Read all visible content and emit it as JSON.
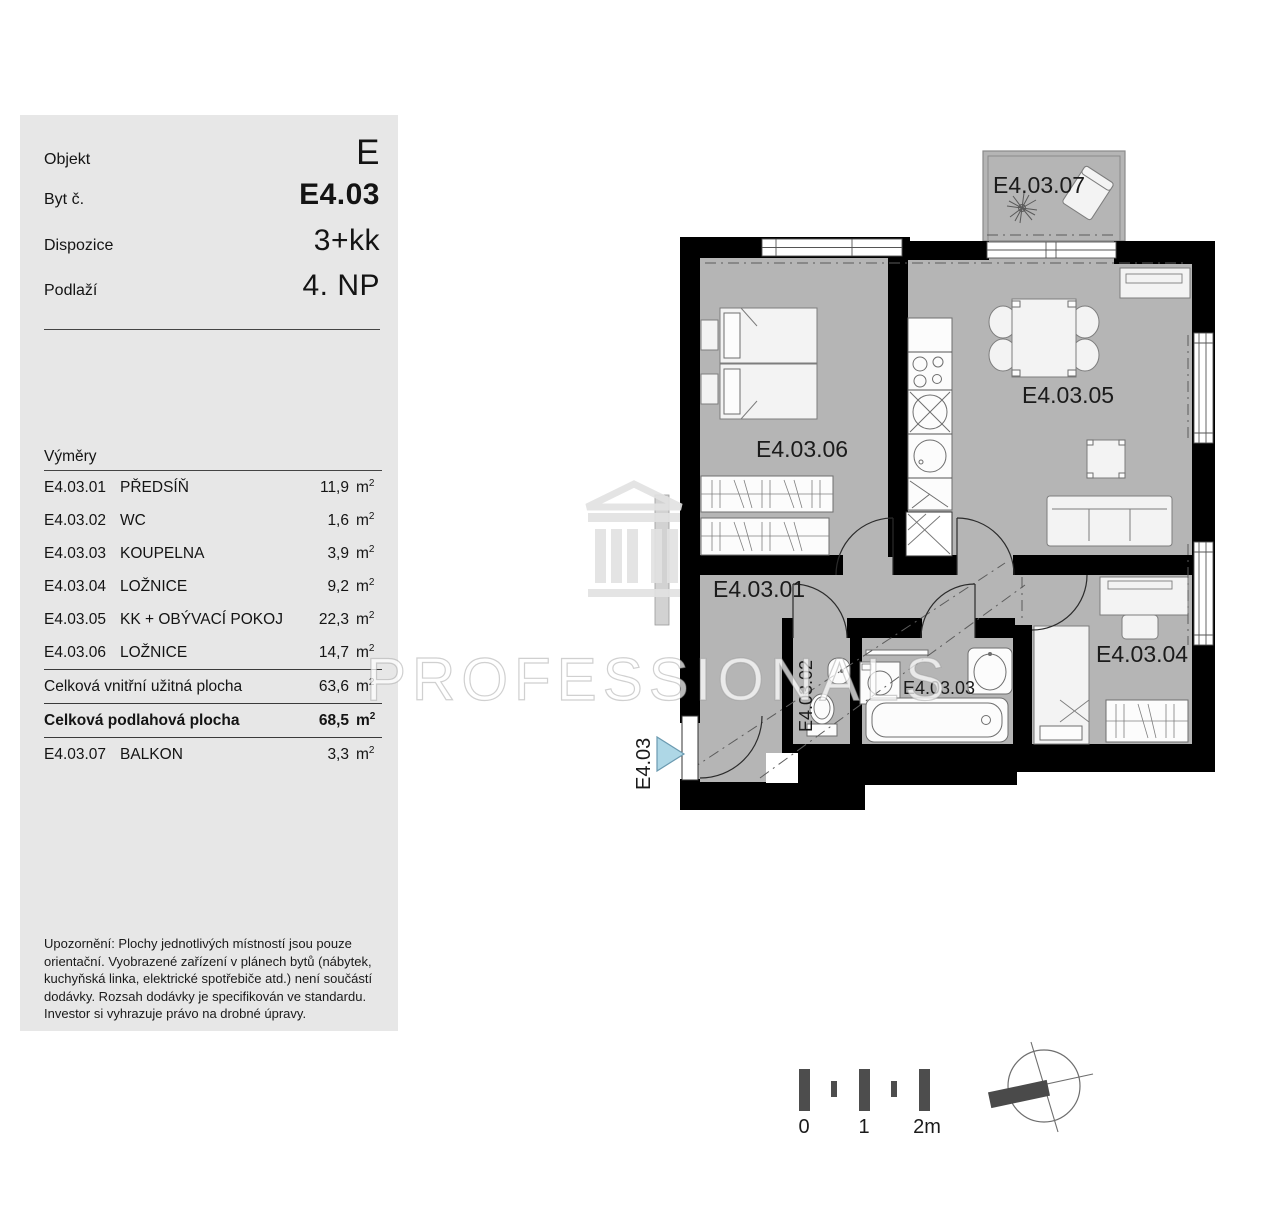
{
  "panel": {
    "header_rows": [
      {
        "label": "Objekt",
        "value": "E"
      },
      {
        "label": "Byt č.",
        "value": "E4.03"
      },
      {
        "label": "Dispozice",
        "value": "3+kk"
      },
      {
        "label": "Podlaží",
        "value": "4. NP"
      }
    ],
    "areas_title": "Výměry",
    "sup": "2",
    "area_rows": [
      {
        "code": "E4.03.01",
        "name": "PŘEDSÍŇ",
        "area": "11,9",
        "unit": "m"
      },
      {
        "code": "E4.03.02",
        "name": "WC",
        "area": "1,6",
        "unit": "m"
      },
      {
        "code": "E4.03.03",
        "name": "KOUPELNA",
        "area": "3,9",
        "unit": "m"
      },
      {
        "code": "E4.03.04",
        "name": "LOŽNICE",
        "area": "9,2",
        "unit": "m"
      },
      {
        "code": "E4.03.05",
        "name": "KK + OBÝVACÍ POKOJ",
        "area": "22,3",
        "unit": "m"
      },
      {
        "code": "E4.03.06",
        "name": "LOŽNICE",
        "area": "14,7",
        "unit": "m"
      }
    ],
    "totals": [
      {
        "name": "Celková vnitřní užitná plocha",
        "area": "63,6",
        "unit": "m"
      },
      {
        "name": "Celková podlahová plocha",
        "area": "68,5",
        "unit": "m"
      }
    ],
    "balcony_row": {
      "code": "E4.03.07",
      "name": "BALKON",
      "area": "3,3",
      "unit": "m"
    },
    "disclaimer": "Upozornění: Plochy jednotlivých místností jsou pouze orientační. Vyobrazené zařízení v plánech bytů (nábytek, kuchyňská linka, elektrické spotřebiče atd.) není součástí dodávky. Rozsah dodávky je specifikován ve standardu. Investor si vyhrazuje právo na drobné úpravy."
  },
  "watermark": {
    "text": "PROFESSIONALS"
  },
  "plan": {
    "room_labels": {
      "hall": "E4.03.01",
      "wc": "E4.03.02",
      "bathroom": "E4.03.03",
      "bedroom_small": "E4.03.04",
      "living": "E4.03.05",
      "bedroom_large": "E4.03.06",
      "balcony": "E4.03.07"
    },
    "entrance_label": "E4.03",
    "colors": {
      "room_fill": "#b5b5b5",
      "wall": "#000000",
      "entrance_arrow": "#aed7e6"
    }
  },
  "scale_bar": {
    "labels": [
      "0",
      "1",
      "2m"
    ]
  }
}
